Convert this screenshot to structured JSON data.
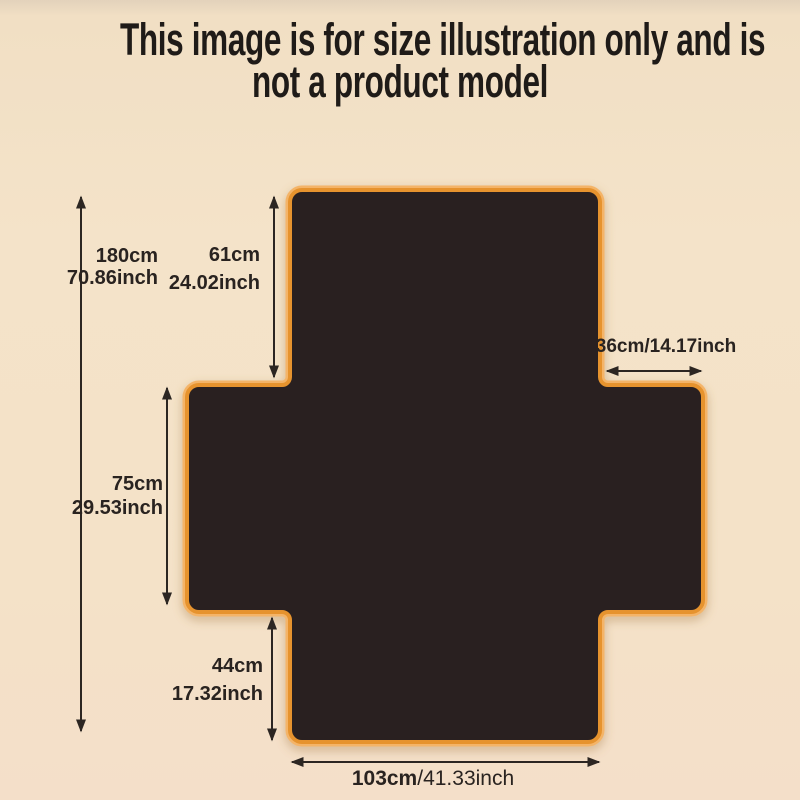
{
  "title": {
    "line1": "This image is for size illustration only and is",
    "line2": "not a product model"
  },
  "labels": {
    "total_height": {
      "cm": "180cm",
      "inch": "70.86inch"
    },
    "top_section_height": {
      "cm": "61cm",
      "inch": "24.02inch"
    },
    "right_wing_width": {
      "text": "36cm/14.17inch"
    },
    "middle_section_height": {
      "cm": "75cm",
      "inch": "29.53inch"
    },
    "bottom_section_height": {
      "cm": "44cm",
      "inch": "17.32inch"
    },
    "bottom_width": {
      "cm": "103cm",
      "inch": "/41.33inch"
    }
  },
  "colors": {
    "background": "#f4e3c9",
    "shape_fill": "#292020",
    "shape_border": "#e6932e",
    "shape_border_light": "#f4b467",
    "text": "#292320",
    "title_text": "#1f1b18"
  }
}
